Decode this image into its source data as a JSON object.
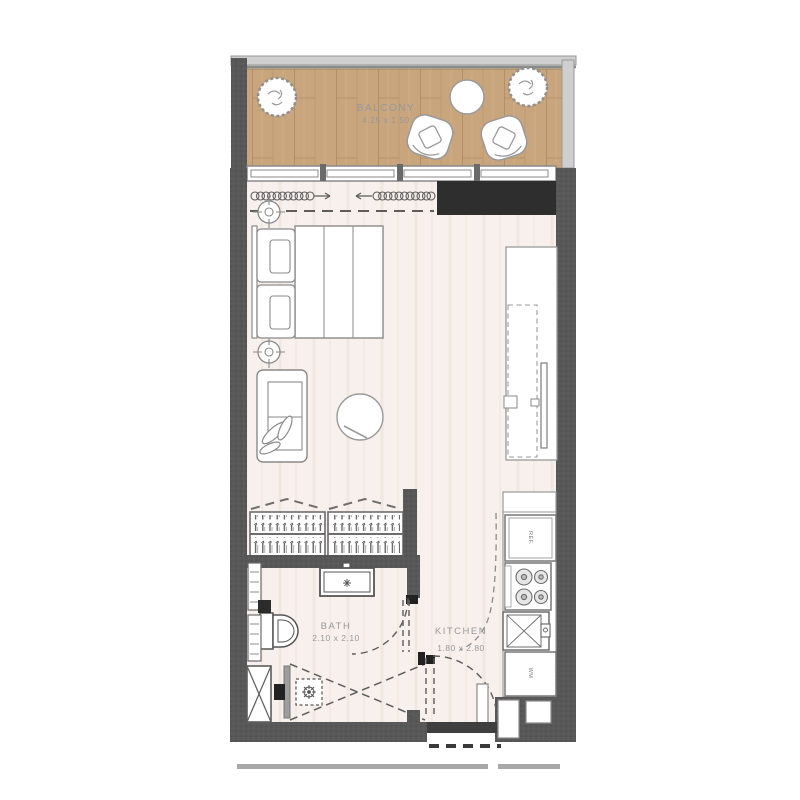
{
  "rooms": {
    "balcony": {
      "name": "BALCONY",
      "dimensions": "4.25 x 1.50"
    },
    "bath": {
      "name": "BATH",
      "dimensions": "2.10 x 2.10"
    },
    "kitchen": {
      "name": "KITCHEN",
      "dimensions": "1.80 x 2.80"
    }
  },
  "appliances": {
    "refrigerator": "REF.",
    "washing_machine": "WM"
  },
  "colors": {
    "background": "#ffffff",
    "wall": "#585858",
    "bulkhead": "#2e2e2e",
    "balcony_wood_floor": "#c8a57d",
    "room_floor": "#f7f0ec",
    "railing": "#cfcfcf",
    "furniture_outline": "#8a8a8a",
    "label_text": "#98999b"
  }
}
